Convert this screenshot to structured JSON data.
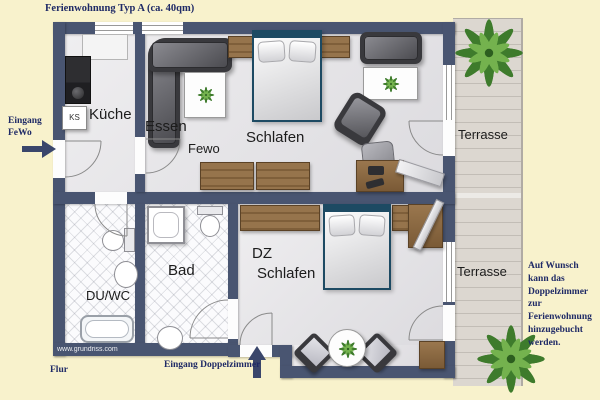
{
  "title": "Ferienwohnung Typ A (ca. 40qm)",
  "annotations": {
    "entrance_fewo_line1": "Eingang",
    "entrance_fewo_line2": "FeWo",
    "flur": "Flur",
    "entrance_dz": "Eingang Doppelzimmer",
    "note": "Auf Wunsch kann das Doppelzimmer zur Ferienwohnung hinzugebucht werden.",
    "watermark": "www.grundriss.com"
  },
  "rooms": {
    "kitchen": "Küche",
    "fridge": "KS",
    "dining": "Essen",
    "living": "Fewo",
    "sleeping_upper": "Schlafen",
    "terrace_upper": "Terrasse",
    "shower_wc": "DU/WC",
    "bath": "Bad",
    "dz_line1": "DZ",
    "dz_line2": "Schlafen",
    "terrace_lower": "Terrasse"
  },
  "colors": {
    "background": "#f8f2cc",
    "wall": "#495571",
    "accent_text": "#1f2a66",
    "floor": "#e7e6e8",
    "terrace": "#dcd7d0",
    "wood": "#8a6742",
    "bed_frame": "#1d4a63",
    "plant_green": "#3e7b2c"
  }
}
